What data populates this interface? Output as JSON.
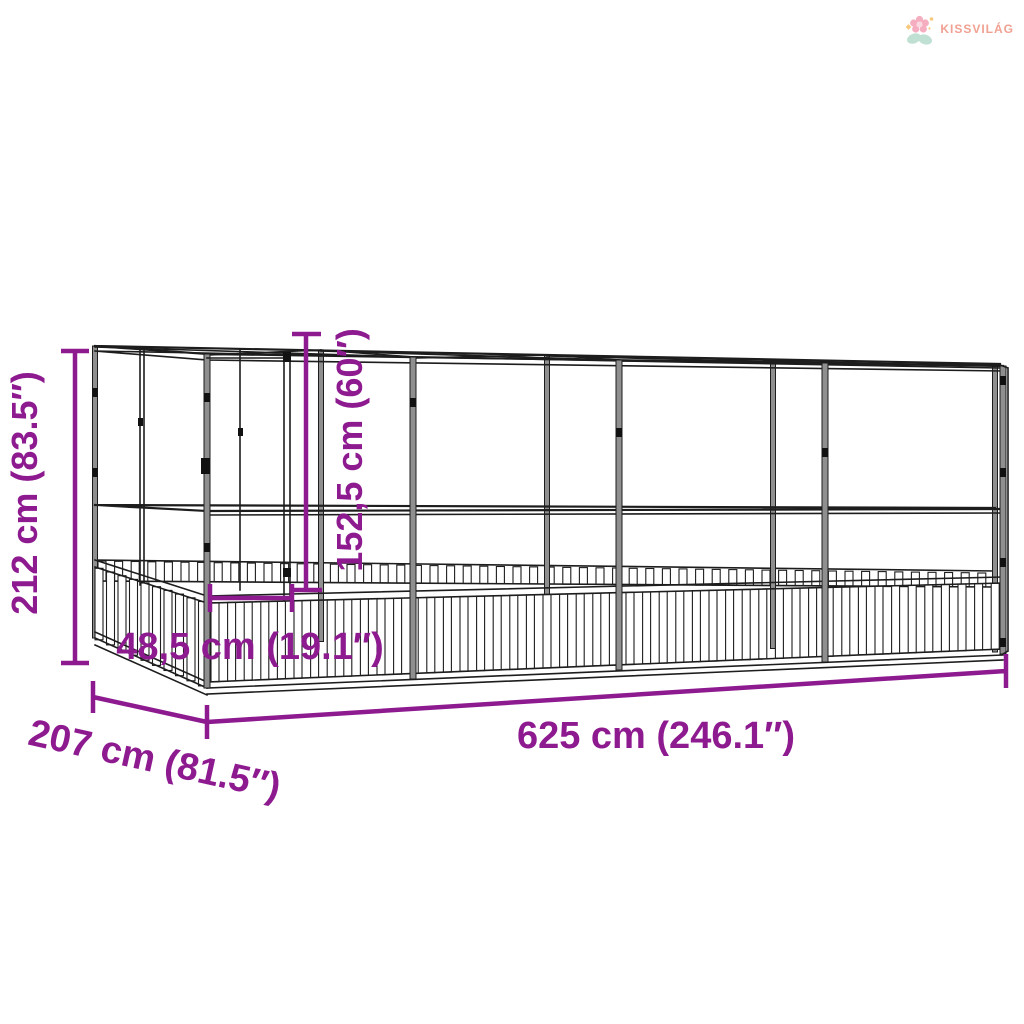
{
  "brand": {
    "name": "KISSVILÁG"
  },
  "colors": {
    "dimension_accent": "#8E1A90",
    "line_art": "#1d1d1d",
    "post_fill": "#8f8f8f",
    "logo_text": "#F0A192",
    "logo_petal": "#F5AEC0",
    "logo_leaf": "#BFE0D2",
    "logo_sparkle": "#F6C97E",
    "background": "#FFFFFF"
  },
  "dimensions": {
    "overall_height": {
      "label": "212 cm (83.5″)"
    },
    "door_height": {
      "label": "152,5 cm (60″)"
    },
    "door_width": {
      "label": "48,5 cm (19.1″)"
    },
    "overall_length": {
      "label": "625 cm (246.1″)"
    },
    "overall_depth": {
      "label": "207 cm (81.5″)"
    }
  }
}
